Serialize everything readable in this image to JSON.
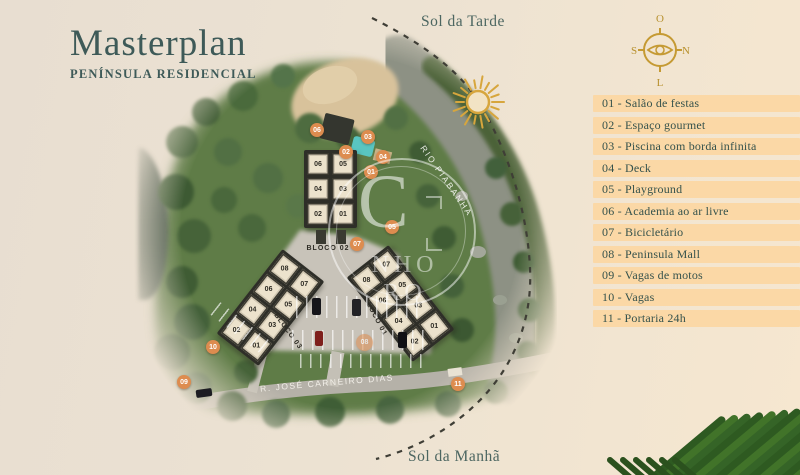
{
  "title": {
    "main": "Masterplan",
    "subtitle": "PENÍNSULA RESIDENCIAL"
  },
  "sun_path": {
    "afternoon": "Sol da Tarde",
    "morning": "Sol da Manhã"
  },
  "compass": {
    "top": "O",
    "right": "N",
    "left": "S",
    "bottom": "L"
  },
  "legend": {
    "items": [
      "01 - Salão de festas",
      "02 - Espaço gourmet",
      "03 - Piscina com borda infinita",
      "04 - Deck",
      "05 - Playground",
      "06 - Academia ao ar livre",
      "07 - Bicicletário",
      "08 - Peninsula Mall",
      "09 - Vagas de motos",
      "10 - Vagas",
      "11 - Portaria 24h"
    ]
  },
  "map": {
    "river_label": "RIO PIABANHA",
    "street_label": "R. JOSÉ CARNEIRO DIAS",
    "blocks": [
      {
        "name": "BLOCO 02",
        "units": [
          "06",
          "05",
          "04",
          "03",
          "02",
          "01"
        ]
      },
      {
        "name": "BLOCO 03",
        "units": [
          "08",
          "07",
          "06",
          "05",
          "04",
          "03",
          "02",
          "01"
        ]
      },
      {
        "name": "BLOCO 01",
        "units": [
          "08",
          "07",
          "06",
          "05",
          "04",
          "03",
          "02",
          "01"
        ]
      }
    ],
    "markers": [
      {
        "num": "01"
      },
      {
        "num": "02"
      },
      {
        "num": "03"
      },
      {
        "num": "04"
      },
      {
        "num": "05"
      },
      {
        "num": "06"
      },
      {
        "num": "07"
      },
      {
        "num": "08"
      },
      {
        "num": "09"
      },
      {
        "num": "10"
      },
      {
        "num": "11"
      }
    ]
  },
  "watermark": {
    "monogram": "C",
    "line1": "NHO",
    "line2": "RO"
  },
  "colors": {
    "accent_gold": "#d7a63d",
    "marker_orange": "#dd8c4f",
    "legend_band": "#fbd8a6",
    "ink": "#3e5a58",
    "pool": "#59c5c1"
  }
}
